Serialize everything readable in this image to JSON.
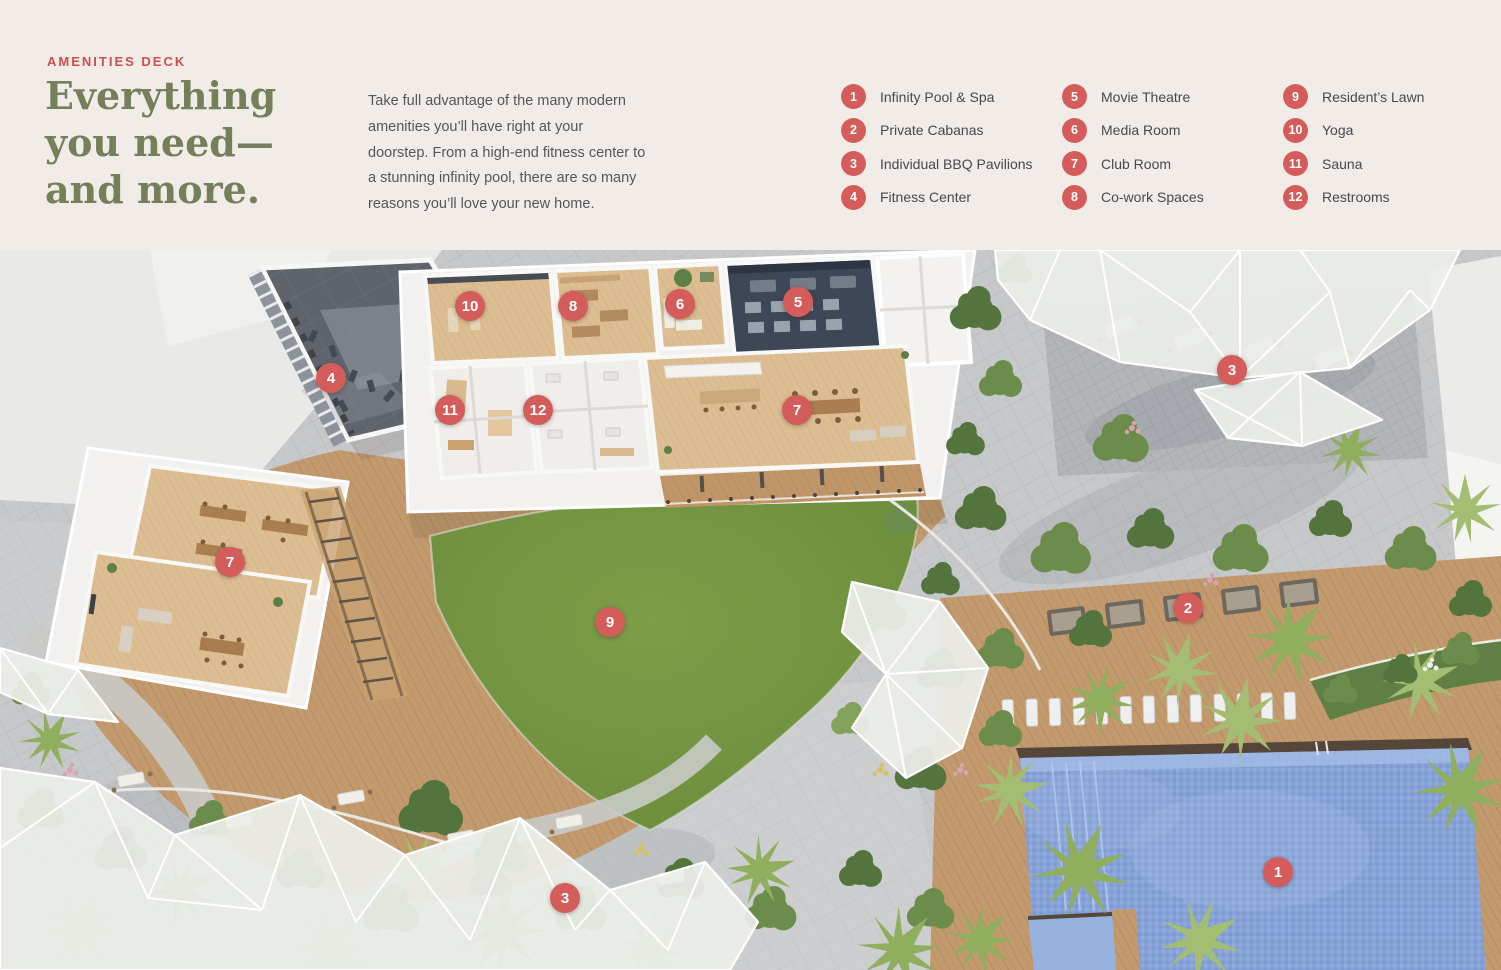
{
  "header": {
    "eyebrow": "AMENITIES DECK",
    "title": "Everything\nyou need—\nand more.",
    "paragraph": "Take full advantage of the many modern amenities you’ll have right at your doorstep. From a high-end fitness center to a stunning infinity pool, there are so many reasons you’ll love your new home."
  },
  "legend": {
    "columns": [
      {
        "items": [
          {
            "number": "1",
            "label": "Infinity Pool & Spa"
          },
          {
            "number": "2",
            "label": "Private Cabanas"
          },
          {
            "number": "3",
            "label": "Individual BBQ Pavilions"
          },
          {
            "number": "4",
            "label": "Fitness Center"
          }
        ]
      },
      {
        "items": [
          {
            "number": "5",
            "label": "Movie Theatre"
          },
          {
            "number": "6",
            "label": "Media Room"
          },
          {
            "number": "7",
            "label": "Club Room"
          },
          {
            "number": "8",
            "label": "Co-work Spaces"
          }
        ]
      },
      {
        "items": [
          {
            "number": "9",
            "label": "Resident’s Lawn"
          },
          {
            "number": "10",
            "label": "Yoga"
          },
          {
            "number": "11",
            "label": "Sauna"
          },
          {
            "number": "12",
            "label": "Restrooms"
          }
        ]
      }
    ]
  },
  "map": {
    "markers": [
      {
        "number": "4",
        "x": 331,
        "y": 128
      },
      {
        "number": "10",
        "x": 470,
        "y": 56
      },
      {
        "number": "8",
        "x": 573,
        "y": 56
      },
      {
        "number": "6",
        "x": 680,
        "y": 54
      },
      {
        "number": "5",
        "x": 798,
        "y": 52
      },
      {
        "number": "11",
        "x": 450,
        "y": 160
      },
      {
        "number": "12",
        "x": 538,
        "y": 160
      },
      {
        "number": "7",
        "x": 797,
        "y": 160
      },
      {
        "number": "3",
        "x": 1232,
        "y": 120
      },
      {
        "number": "7",
        "x": 230,
        "y": 312
      },
      {
        "number": "9",
        "x": 610,
        "y": 372
      },
      {
        "number": "2",
        "x": 1188,
        "y": 358
      },
      {
        "number": "1",
        "x": 1278,
        "y": 622
      },
      {
        "number": "3",
        "x": 565,
        "y": 648
      }
    ]
  },
  "colors": {
    "accent": "#d45d5c",
    "eyebrow": "#cb4f4c",
    "heading": "#73805a",
    "body_text": "#55565a",
    "page_background": "#f2ece8"
  }
}
